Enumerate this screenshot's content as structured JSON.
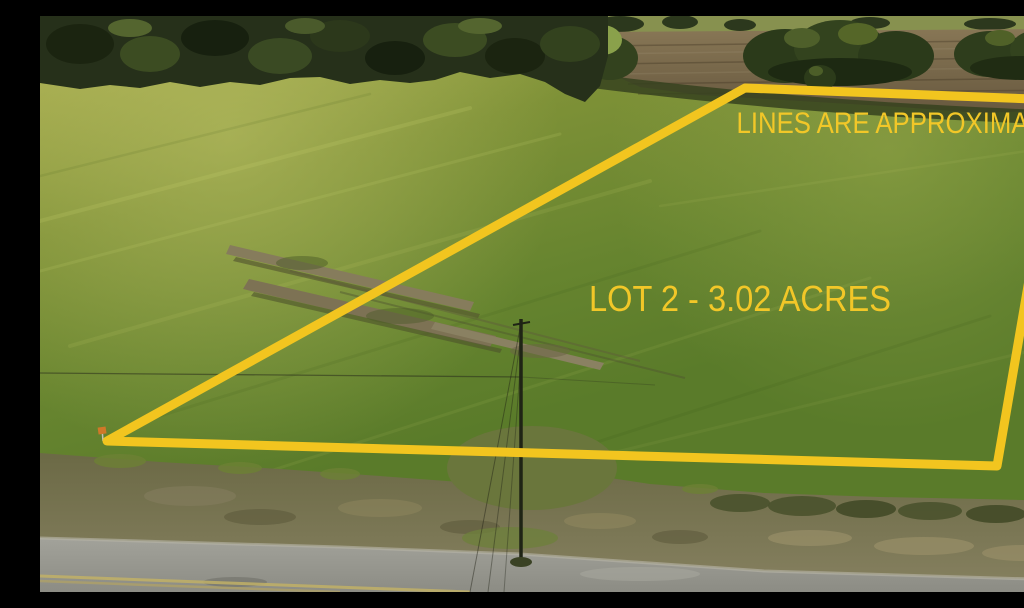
{
  "overlay": {
    "disclaimer_label": "LINES ARE APPROXIMATE",
    "lot_label": "LOT 2 - 3.02 ACRES",
    "boundary_color": "#F2C51F",
    "text_color": "#F2C728"
  },
  "scene": {
    "description": "Aerial drone photo of a mowed green pasture lot outlined in yellow, with a dark treeline at top, a brown plowed field at upper right, dirt scrape marks mid-field, a utility pole with wires, a scrubby roadside ditch, and a gray asphalt road with faded yellow center line at bottom",
    "colors": {
      "field_light": "#A5AB4D",
      "field_mid": "#7E9137",
      "field_dark": "#5A7B2A",
      "treeline": "#26301A",
      "plowed_field": "#7D6C4F",
      "distant_field": "#87914F",
      "dirt_marks": "#857B5B",
      "ditch": "#74714C",
      "road": "#9A9A92",
      "road_stripe": "#C1B066"
    }
  }
}
